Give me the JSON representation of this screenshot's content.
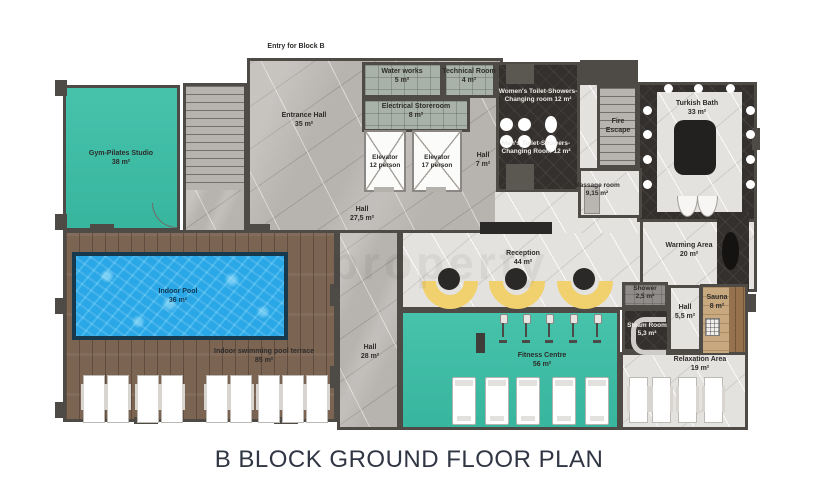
{
  "title": "B BLOCK GROUND FLOOR PLAN",
  "entry_label": "Entry for Block B",
  "watermark": "property",
  "colors": {
    "teal": "#3bbfa6",
    "pool_blue": "#2aa7e7",
    "terrace_wood": "#7c6453",
    "sauna_wood": "#96714e",
    "marble_gray": "#b7b3af",
    "spa_floor": "#e4e2df",
    "dark_tile": "#34302d",
    "utility_tile": "#a9b2a8",
    "wall": "#4e4a46",
    "sofa_yellow": "#f1d06e",
    "title_text": "#303644"
  },
  "rooms": {
    "gym": {
      "name": "Gym-Pilates Studio",
      "area": "38 m²"
    },
    "entrance_hall": {
      "name": "Entrance Hall",
      "area": "35 m²"
    },
    "water_works": {
      "name": "Water works",
      "area": "5 m²"
    },
    "technical_room": {
      "name": "Technical Room",
      "area": "4 m²"
    },
    "electrical_storeroom": {
      "name": "Electrical Storeroom",
      "area": "8 m²"
    },
    "elevator_12": {
      "name": "Elevator",
      "capacity": "12 person"
    },
    "elevator_17": {
      "name": "Elevator",
      "capacity": "17 person"
    },
    "hall_7": {
      "name": "Hall",
      "area": "7 m²"
    },
    "womens_changing": {
      "name": "Women's Toilet-Showers-Changing room",
      "area": "12 m²"
    },
    "mens_changing": {
      "name": "Men's Toilet-Showers-Changing Room",
      "area": "12 m²"
    },
    "fire_escape": {
      "name": "Fire Escape"
    },
    "turkish_bath": {
      "name": "Turkish Bath",
      "area": "33 m²"
    },
    "massage_room": {
      "name": "Massage room",
      "area": "9,15 m²"
    },
    "hall_27": {
      "name": "Hall",
      "area": "27,5 m²"
    },
    "reception": {
      "name": "Reception",
      "area": "44 m²"
    },
    "warming_area": {
      "name": "Warming Area",
      "area": "20 m²"
    },
    "shower": {
      "name": "Shower",
      "area": "2,5 m²"
    },
    "steam_room": {
      "name": "Steam Room",
      "area": "5,3 m²"
    },
    "hall_5": {
      "name": "Hall",
      "area": "5,5 m²"
    },
    "sauna": {
      "name": "Sauna",
      "area": "8 m²"
    },
    "relaxation_area": {
      "name": "Relaxation Area",
      "area": "19 m²"
    },
    "indoor_pool": {
      "name": "Indoor Pool",
      "area": "36 m²"
    },
    "pool_terrace": {
      "name": "Indoor swimming pool terrace",
      "area": "85 m²"
    },
    "hall_28": {
      "name": "Hall",
      "area": "28 m²"
    },
    "fitness_centre": {
      "name": "Fitness Centre",
      "area": "56 m²"
    }
  }
}
